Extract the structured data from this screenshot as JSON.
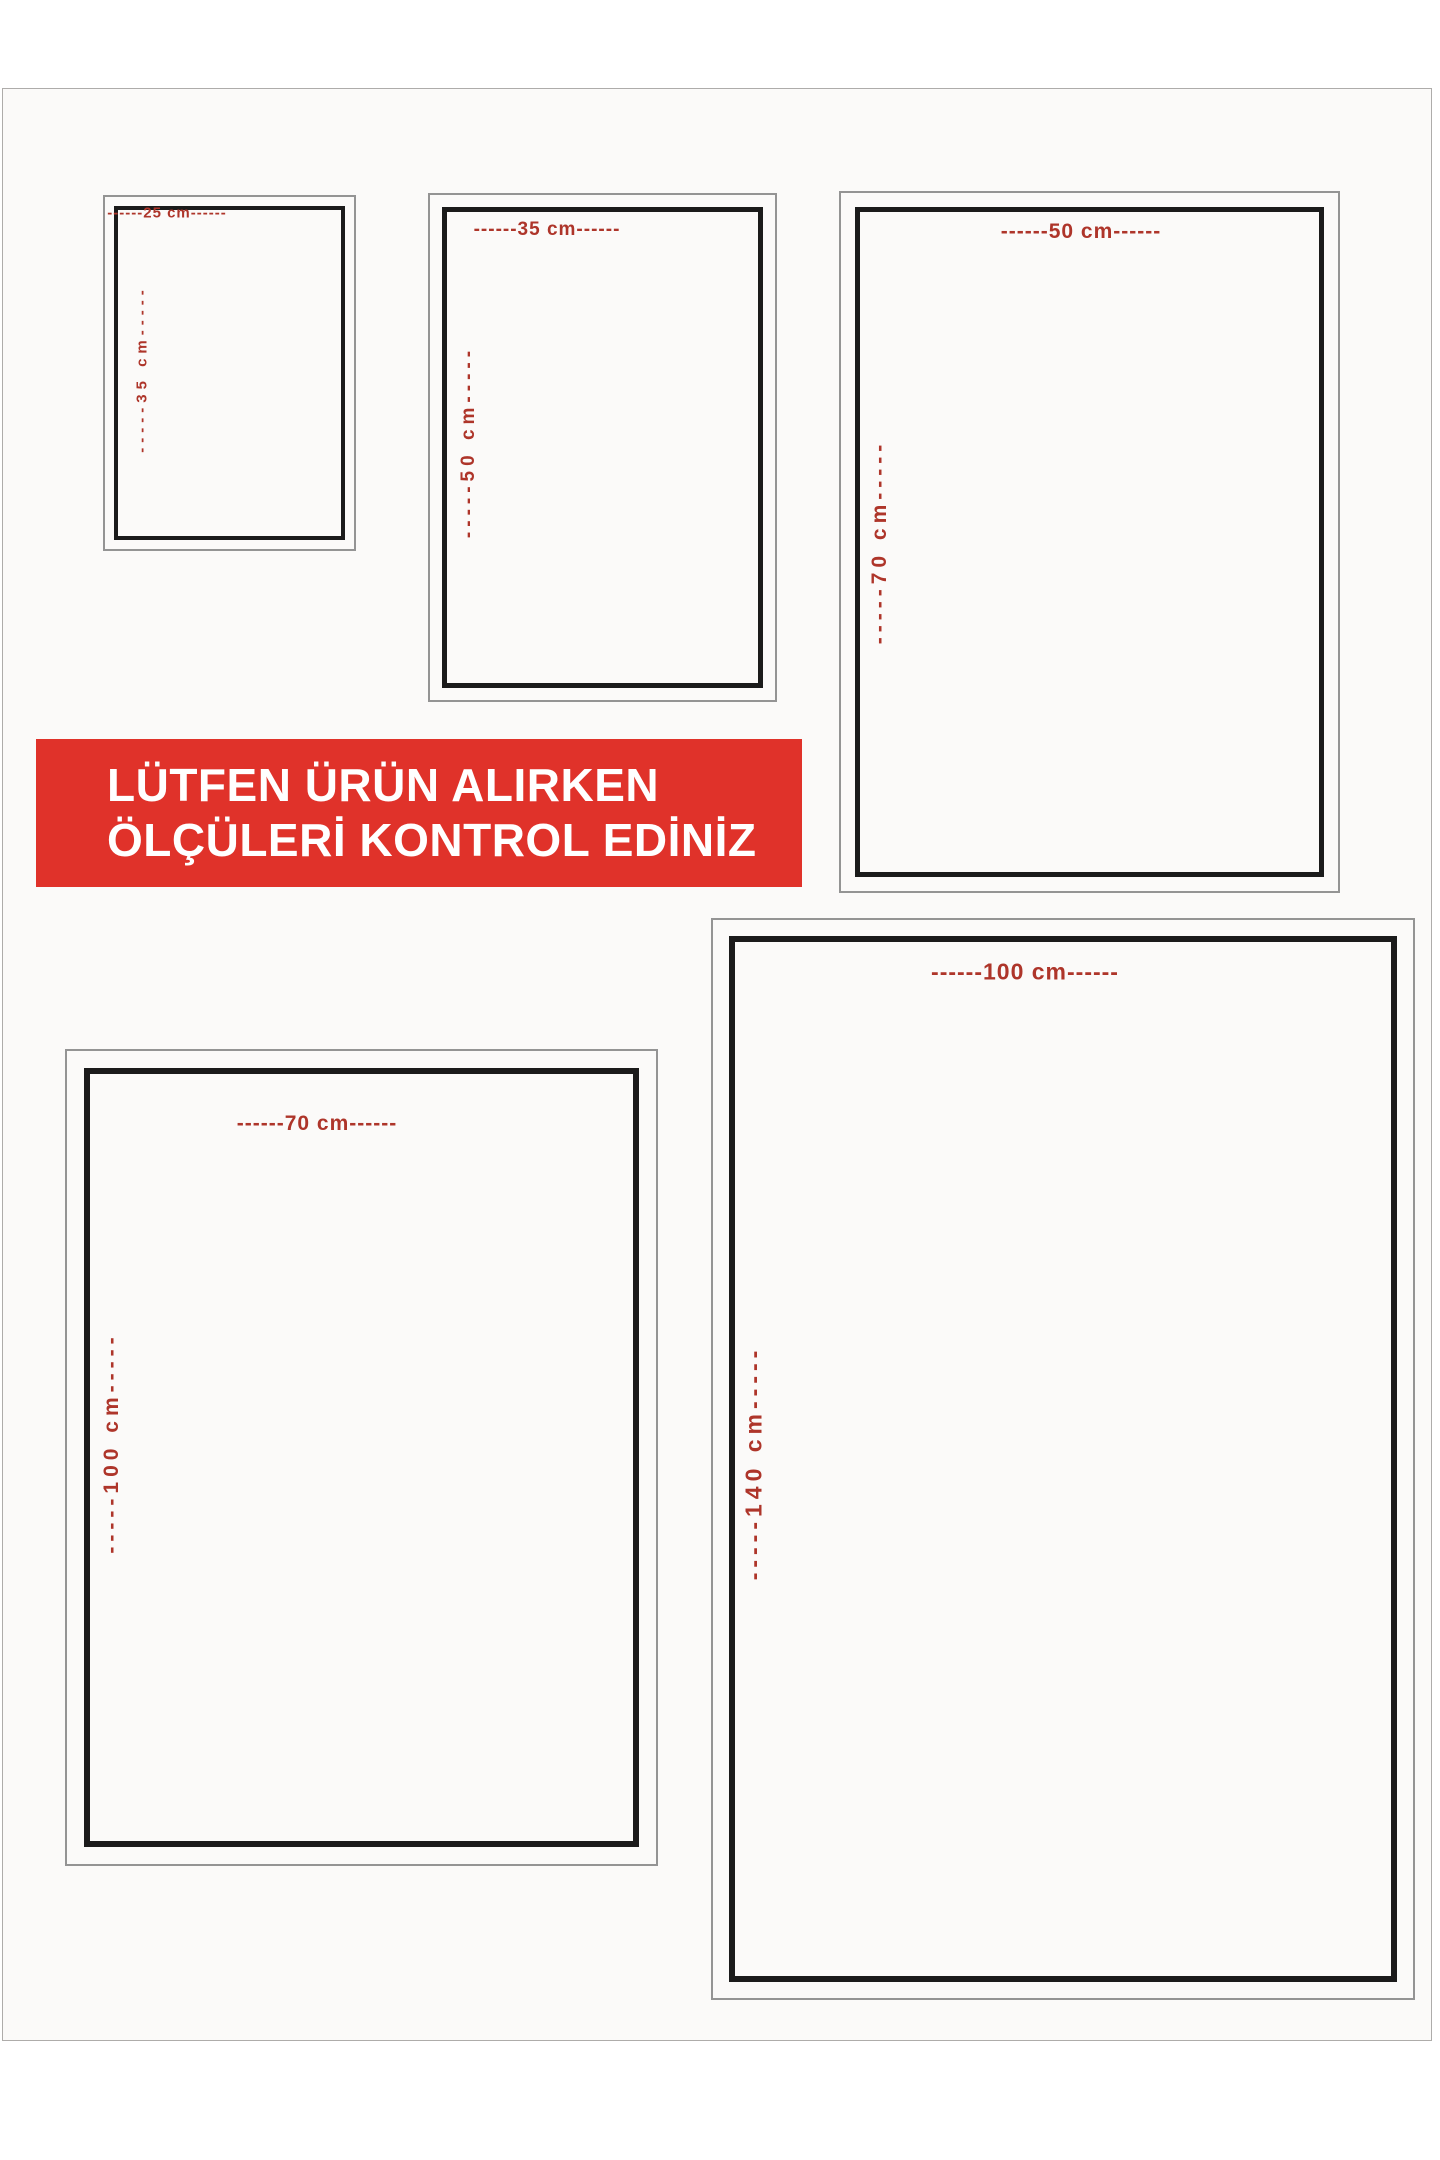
{
  "banner": {
    "line1": "LÜTFEN ÜRÜN ALIRKEN",
    "line2": "ÖLÇÜLERİ KONTROL EDİNİZ"
  },
  "colors": {
    "page_bg": "#ffffff",
    "photo_bg": "#fbfaf9",
    "photo_edge": "#aeacaa",
    "frame_black": "#1b1b1b",
    "frame_gray": "#949494",
    "label_red": "#ae352a",
    "banner_red": "#e0322a",
    "banner_text": "#ffffff"
  },
  "size_boxes": [
    {
      "name": "25x35",
      "width_cm": 25,
      "height_cm": 35,
      "top_label": "------25 cm------",
      "side_label": "-----35 cm-----"
    },
    {
      "name": "35x50",
      "width_cm": 35,
      "height_cm": 50,
      "top_label": "------35 cm------",
      "side_label": "-----50 cm-----"
    },
    {
      "name": "50x70",
      "width_cm": 50,
      "height_cm": 70,
      "top_label": "------50 cm------",
      "side_label": "-----70 cm-----"
    },
    {
      "name": "70x100",
      "width_cm": 70,
      "height_cm": 100,
      "top_label": "------70 cm------",
      "side_label": "-----100 cm-----"
    },
    {
      "name": "100x140",
      "width_cm": 100,
      "height_cm": 140,
      "top_label": "------100 cm------",
      "side_label": "-----140 cm-----"
    }
  ]
}
